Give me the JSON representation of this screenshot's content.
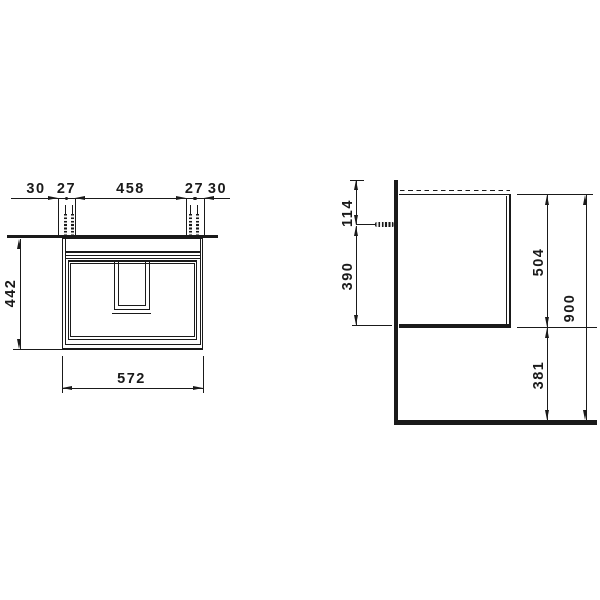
{
  "front": {
    "chain": [
      "30",
      "27",
      "458",
      "27",
      "30"
    ],
    "height": "442",
    "width": "572"
  },
  "side": {
    "offset_top": "114",
    "screw_to_bottom": "390",
    "body_height": "504",
    "clearance": "381",
    "total_height": "900"
  },
  "colors": {
    "ink": "#1a1a1a",
    "background": "#ffffff"
  }
}
